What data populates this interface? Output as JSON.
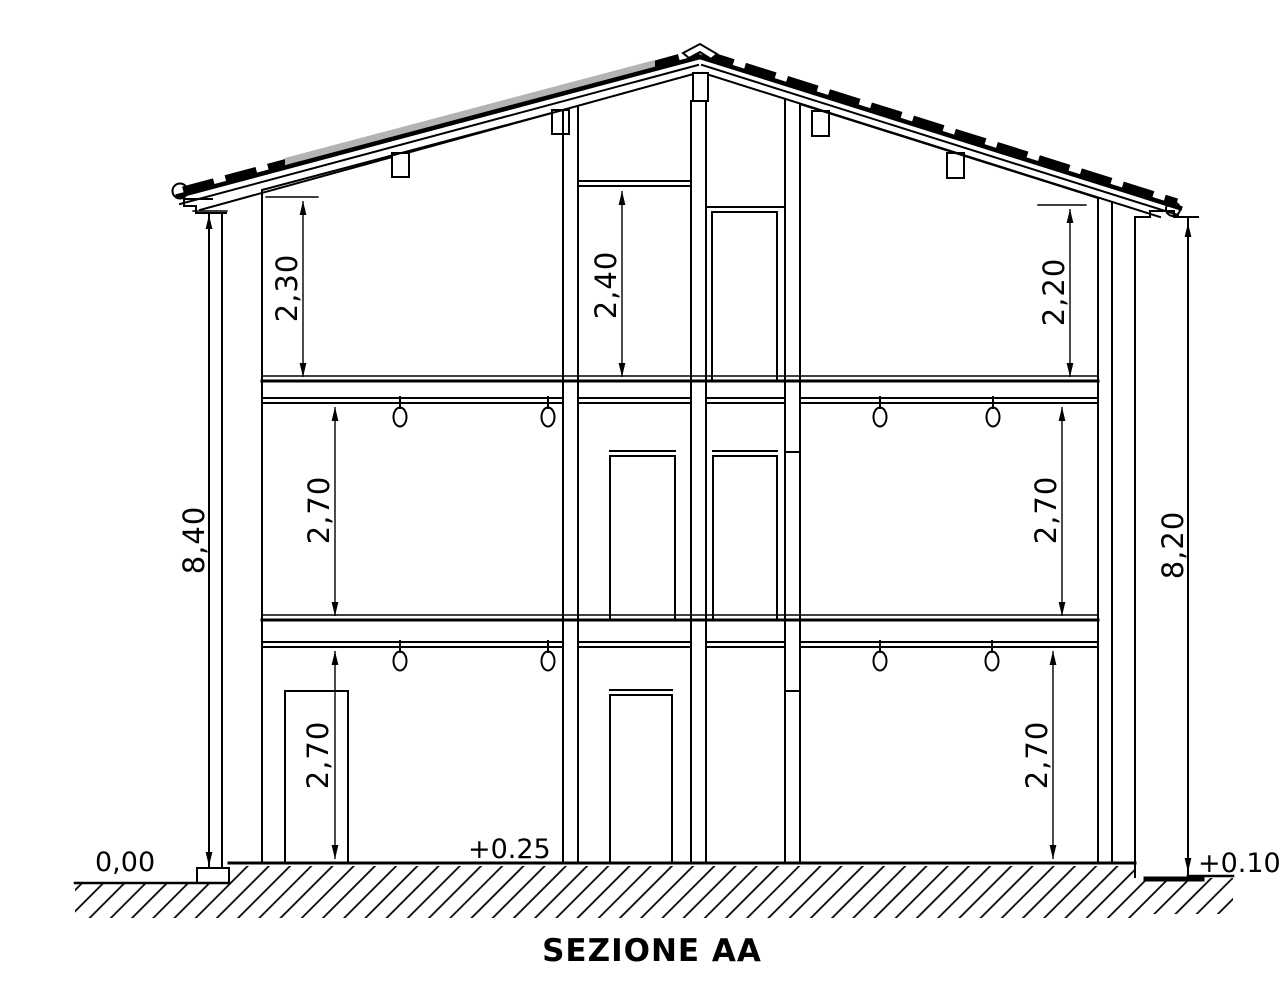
{
  "drawing": {
    "title": "SEZIONE AA",
    "dims": {
      "total_left": "8,40",
      "total_right": "8,20",
      "attic_left": "2,30",
      "attic_center": "2,40",
      "attic_right": "2,20",
      "first_left": "2,70",
      "first_right": "2,70",
      "ground_left": "2,70",
      "ground_right": "2,70"
    },
    "levels": {
      "street_left": "0,00",
      "interior": "+0.25",
      "street_right": "+0.10"
    },
    "colors": {
      "ink": "#000000",
      "paper": "#ffffff",
      "roof_shade": "#b3b3b3"
    }
  }
}
